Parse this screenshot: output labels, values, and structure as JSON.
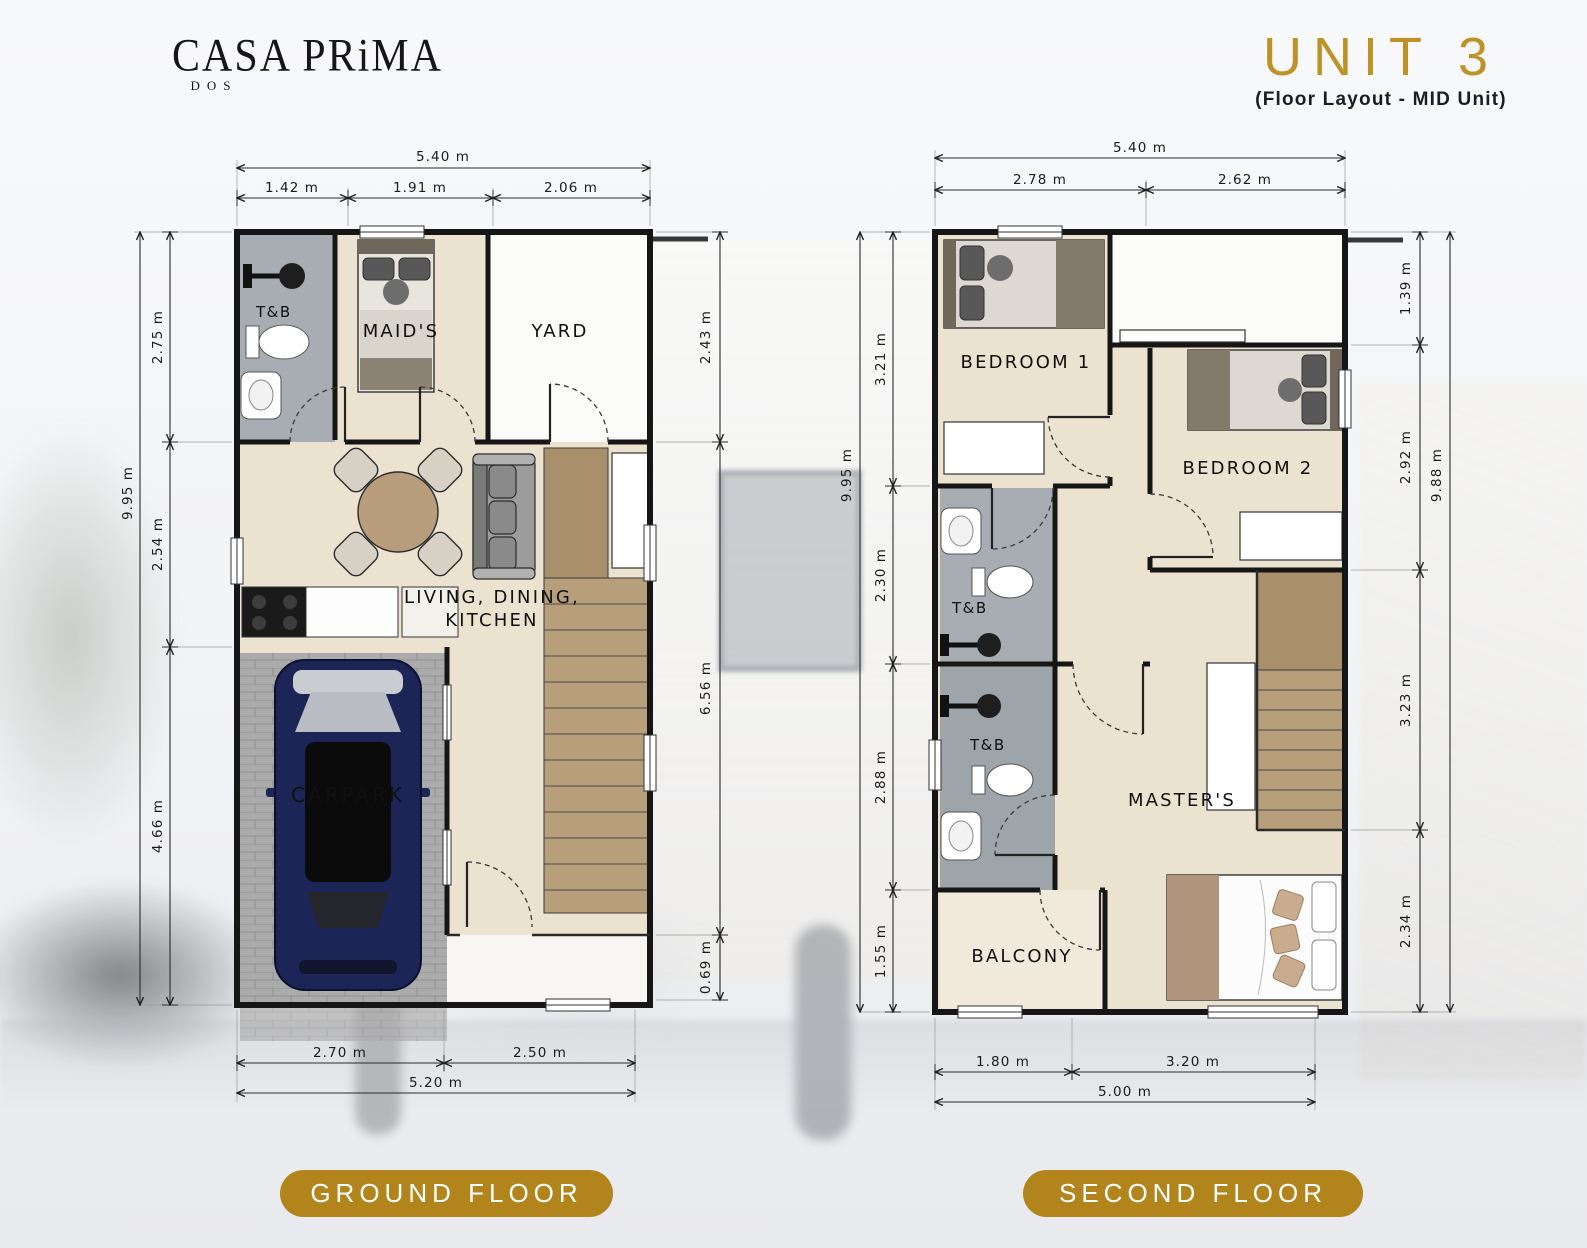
{
  "brand": {
    "name": "CASA PRiMA",
    "sub": "DOS"
  },
  "unit": {
    "title": "UNIT 3",
    "subtitle": "(Floor Layout - MID Unit)"
  },
  "colors": {
    "accent_gold": "#BD9227",
    "pill_gold": "#B2841C"
  },
  "ground_floor": {
    "label": "GROUND FLOOR",
    "dims": {
      "top_total": "5.40 m",
      "top_segments": [
        "1.42 m",
        "1.91 m",
        "2.06 m"
      ],
      "left_total": "9.95 m",
      "left_segments": [
        "2.75 m",
        "2.54 m",
        "4.66 m"
      ],
      "right_segments": [
        "2.43 m",
        "6.56 m",
        "0.69 m"
      ],
      "bottom_segments": [
        "2.70 m",
        "2.50 m"
      ],
      "bottom_total": "5.20 m"
    },
    "rooms": {
      "tb": "T&B",
      "maids": "MAID'S",
      "yard": "YARD",
      "living_line1": "LIVING, DINING,",
      "living_line2": "KITCHEN",
      "carpark": "CARPARK"
    }
  },
  "second_floor": {
    "label": "SECOND FLOOR",
    "dims": {
      "top_total": "5.40 m",
      "top_segments": [
        "2.78 m",
        "2.62 m"
      ],
      "left_total": "9.95 m",
      "left_segments": [
        "3.21 m",
        "2.30 m",
        "2.88 m",
        "1.55 m"
      ],
      "right_total": "9.88 m",
      "right_segments": [
        "1.39 m",
        "2.92 m",
        "3.23 m",
        "2.34 m"
      ],
      "bottom_segments": [
        "1.80 m",
        "3.20 m"
      ],
      "bottom_total": "5.00 m"
    },
    "rooms": {
      "bedroom1": "BEDROOM 1",
      "bedroom2": "BEDROOM 2",
      "tb1": "T&B",
      "tb2": "T&B",
      "masters": "MASTER'S",
      "balcony": "BALCONY"
    }
  }
}
